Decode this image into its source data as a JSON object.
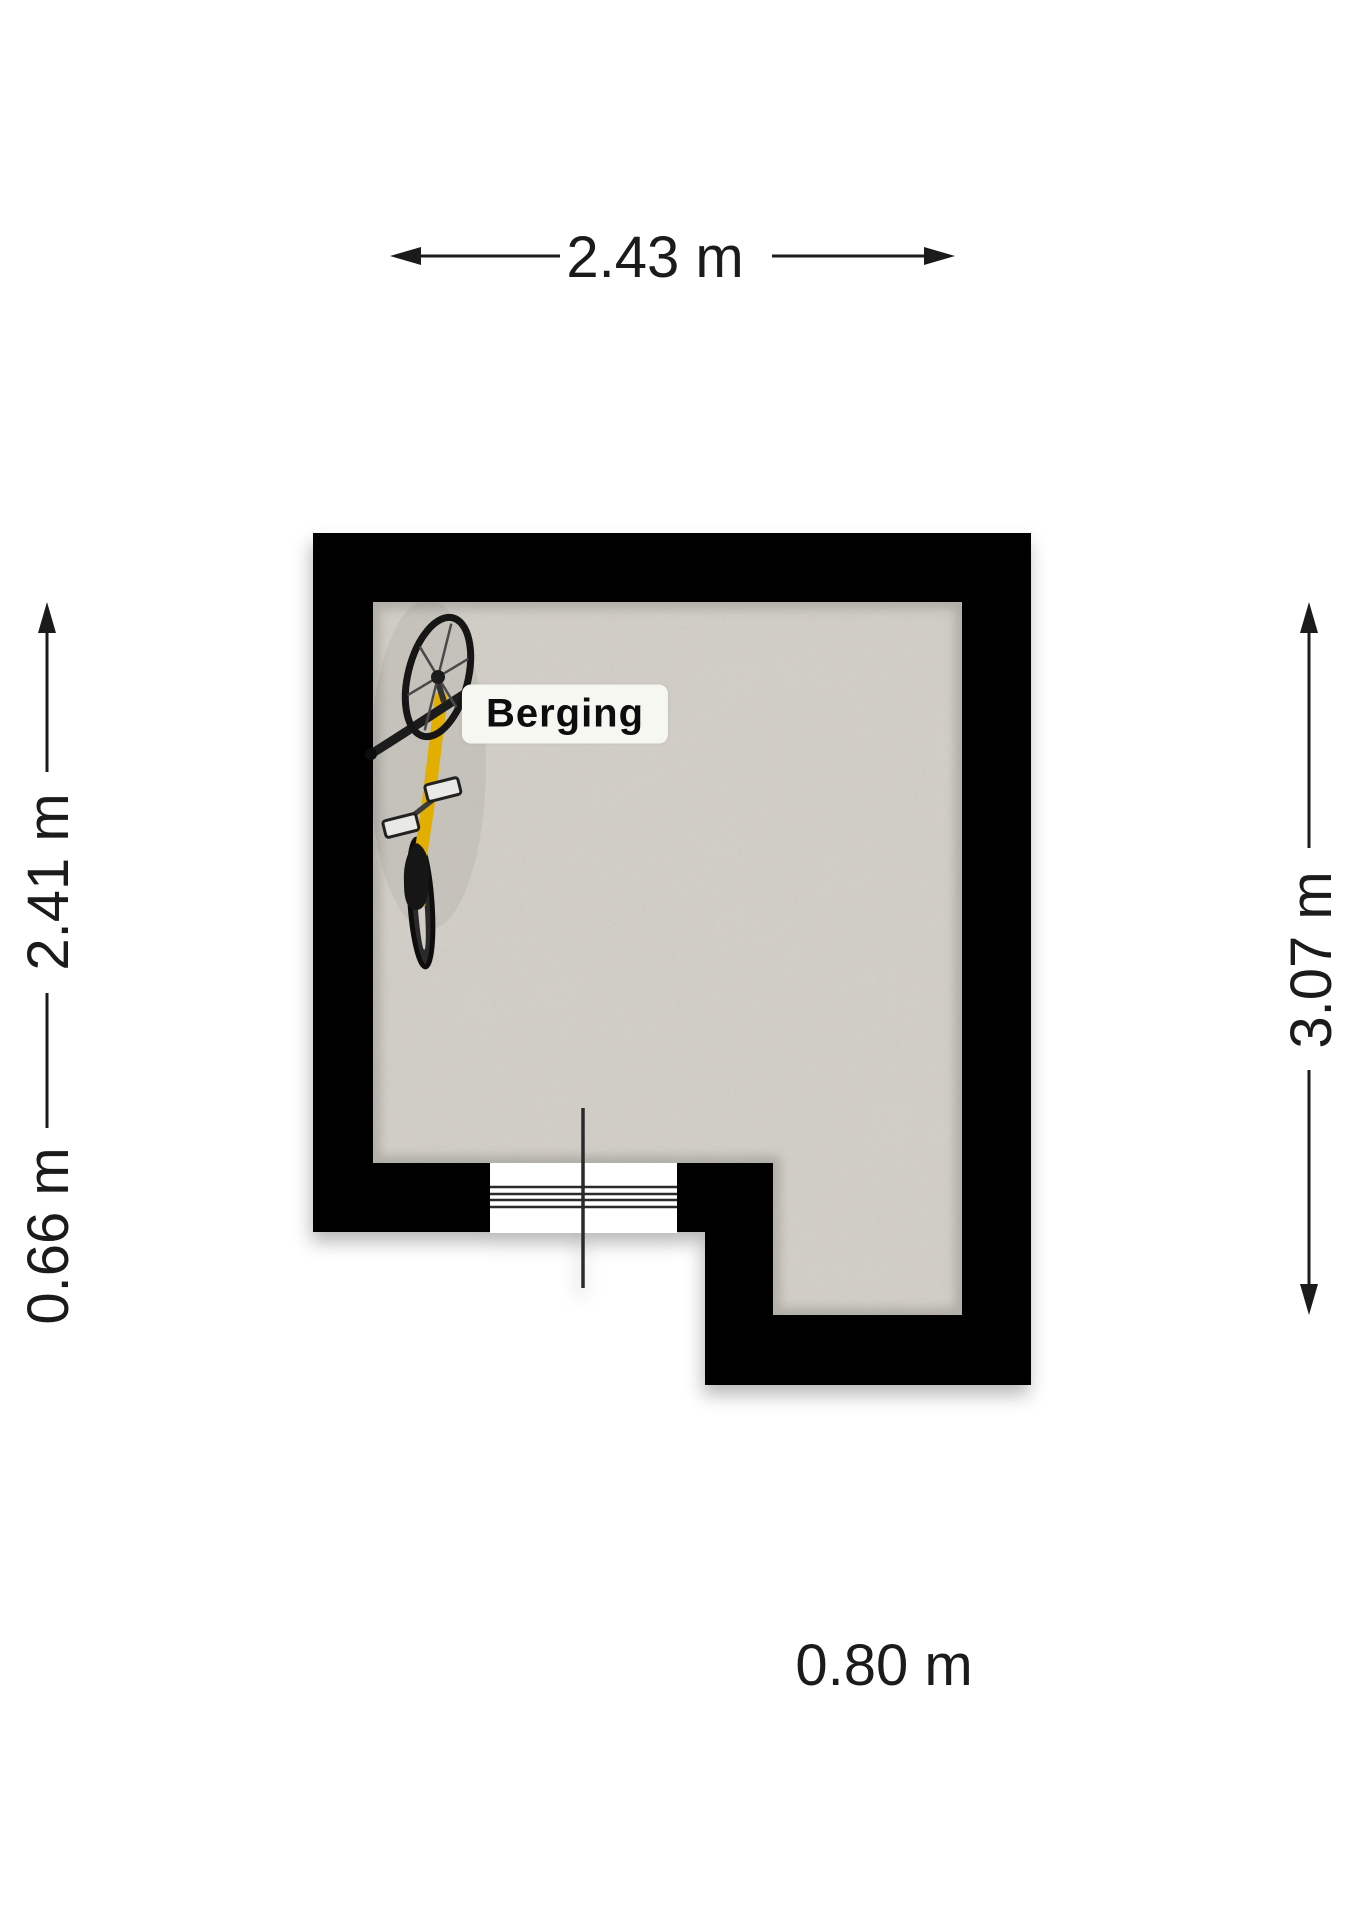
{
  "floorplan": {
    "room": {
      "label": "Berging"
    },
    "dimensions": {
      "width_top": "2.43 m",
      "height_left_upper": "2.41 m",
      "height_left_lower": "0.66 m",
      "height_right": "3.07 m",
      "width_bottom": "0.80 m"
    },
    "colors": {
      "wall": "#000000",
      "floor_base": "#d6d3cb",
      "door_lines": "#2a2a2a",
      "dimension_text": "#1b1b1b",
      "bike_frame_yellow": "#e2ae00",
      "room_label_bg": "#f7f7f2",
      "background": "#ffffff"
    },
    "objects": {
      "bicycle": "bicycle-top-view"
    }
  }
}
